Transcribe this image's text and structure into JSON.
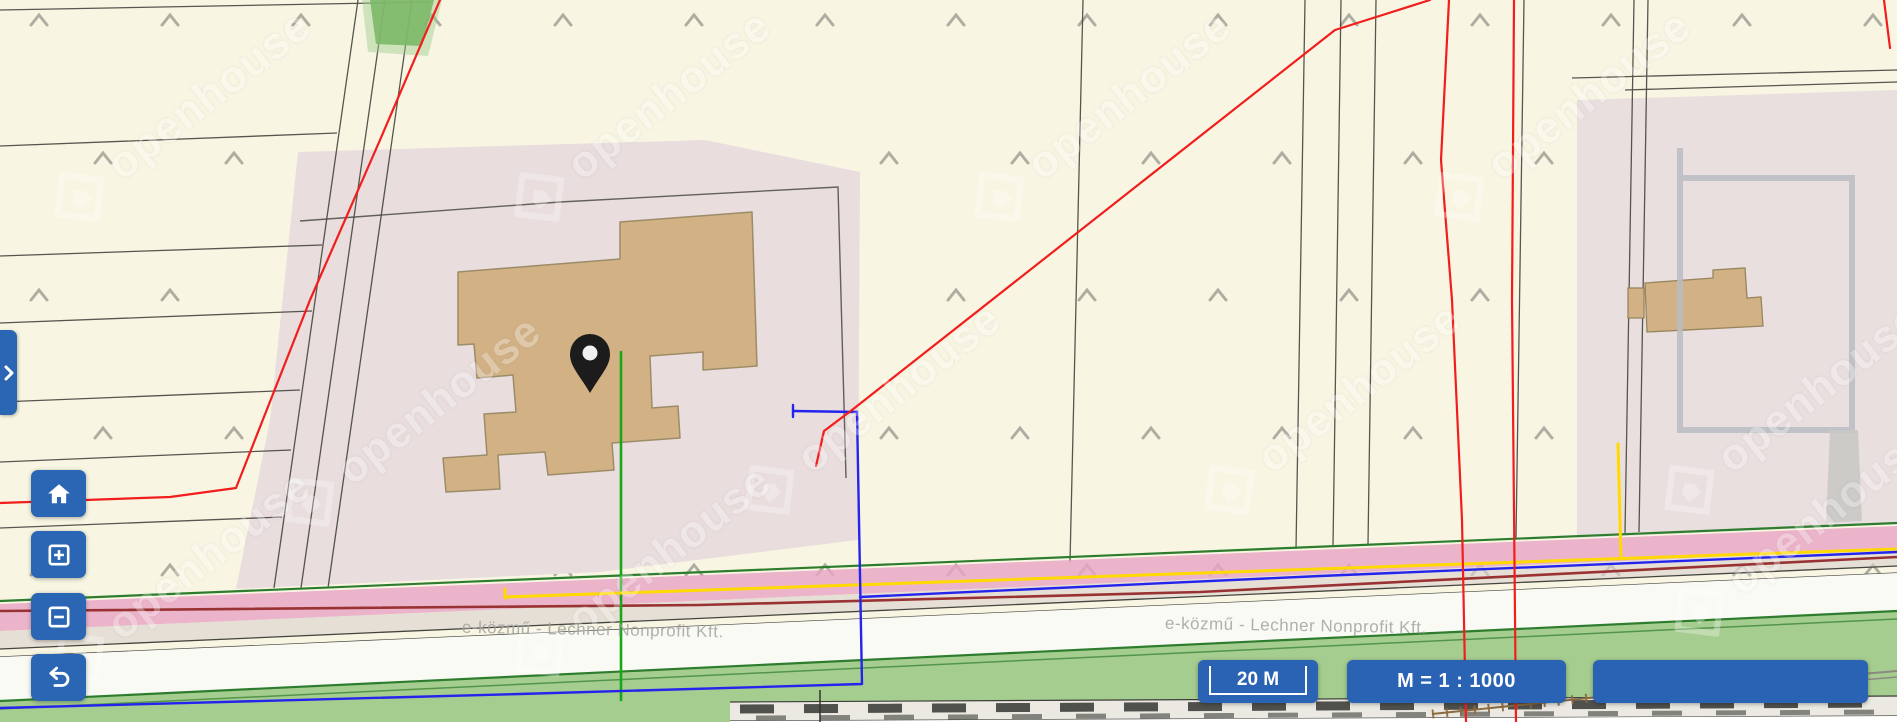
{
  "ui": {
    "scale_bar": {
      "label": "20 M"
    },
    "scale_ratio": {
      "label": "M = 1 : 1000"
    },
    "info_box": {
      "label": ""
    },
    "watermark": {
      "brand": "openhouse",
      "provider": "e-közmű - Lechner Nonprofit Kft."
    }
  },
  "controls": {
    "expand": "expand-panel",
    "home": "reset-view",
    "zoom_in": "zoom-in",
    "zoom_out": "zoom-out",
    "back": "previous-view"
  },
  "colors": {
    "ui_blue": "#2a64b3",
    "map_background": "#f8f6e3",
    "parcel_fill": "#e9dddd",
    "building_fill": "#d2b185",
    "road_pink": "#e8a4c4",
    "vegetation_green": "#a6cd90",
    "utility_red": "#f21d1d",
    "utility_blue": "#2424ec",
    "utility_green": "#17a817",
    "utility_yellow": "#ffd900"
  }
}
